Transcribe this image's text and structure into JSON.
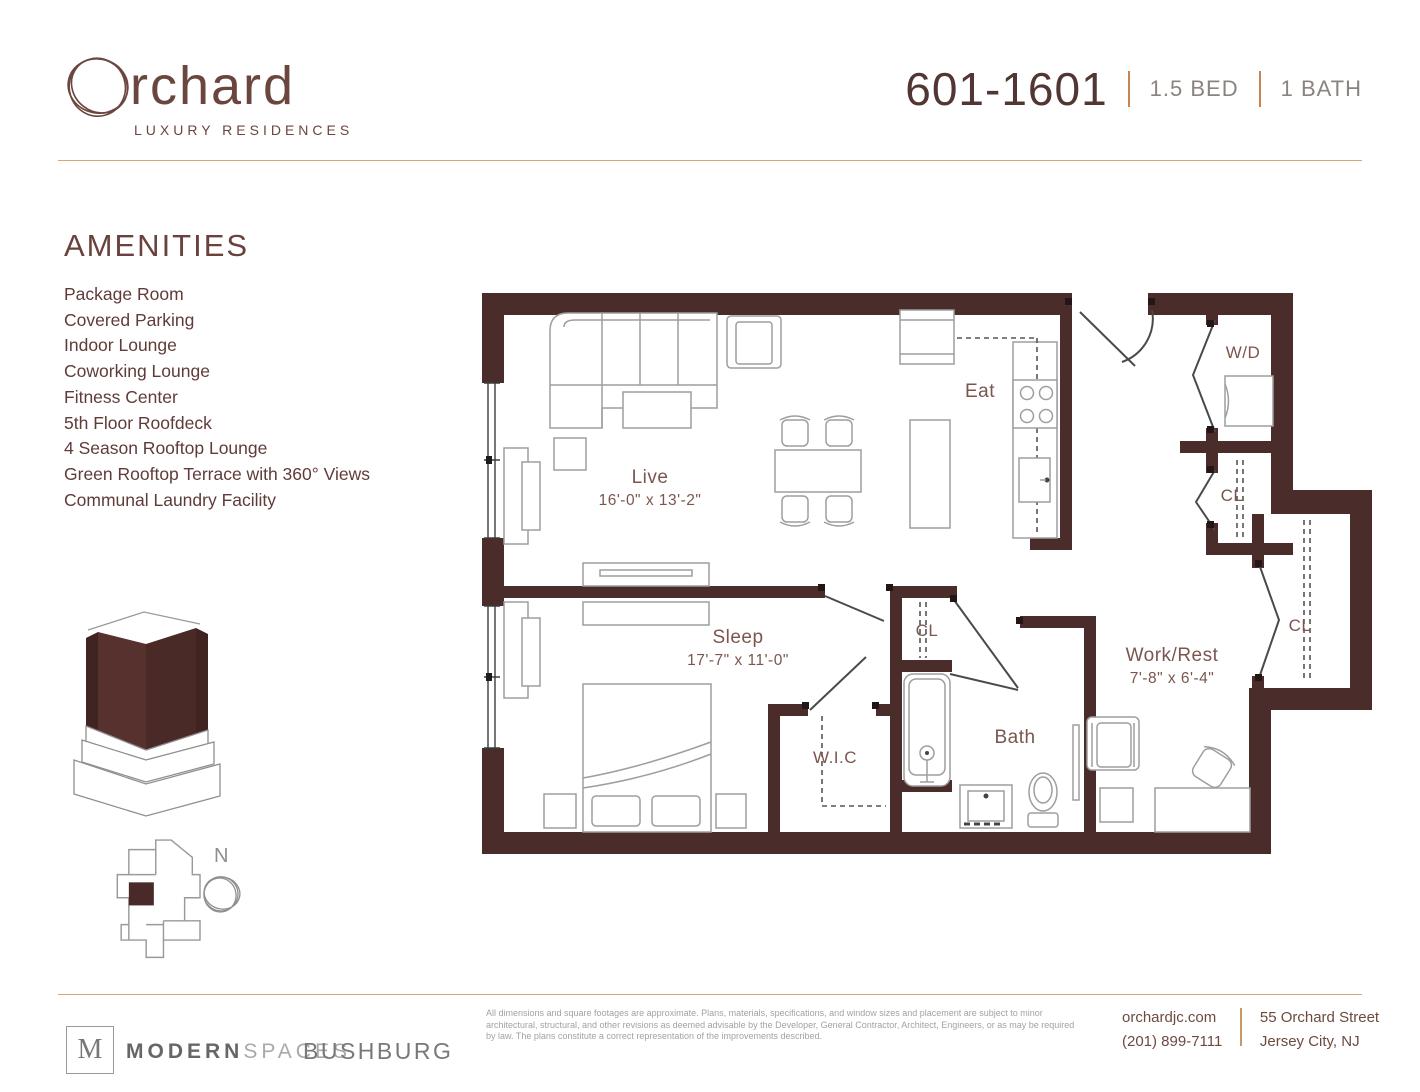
{
  "brand": {
    "name_initial": "O",
    "name_rest": "rchard",
    "tagline": "LUXURY RESIDENCES"
  },
  "unit": {
    "number": "601-1601",
    "bed": "1.5 BED",
    "bath": "1 BATH"
  },
  "amenities": {
    "title": "AMENITIES",
    "items": [
      "Package Room",
      "Covered Parking",
      "Indoor Lounge",
      "Coworking Lounge",
      "Fitness Center",
      "5th Floor Roofdeck",
      "4 Season Rooftop Lounge",
      "Green Rooftop Terrace with 360° Views",
      "Communal Laundry Facility"
    ]
  },
  "floorplan": {
    "rooms": [
      {
        "name": "Live",
        "dims": "16'-0\" x 13'-2\""
      },
      {
        "name": "Eat",
        "dims": ""
      },
      {
        "name": "W/D",
        "dims": ""
      },
      {
        "name": "CL",
        "dims": ""
      },
      {
        "name": "CL",
        "dims": ""
      },
      {
        "name": "Sleep",
        "dims": "17'-7\" x 11'-0\""
      },
      {
        "name": "CL",
        "dims": ""
      },
      {
        "name": "W.I.C",
        "dims": ""
      },
      {
        "name": "Bath",
        "dims": ""
      },
      {
        "name": "Work/Rest",
        "dims": "7'-8\" x 6'-4\""
      }
    ],
    "north_label": "N"
  },
  "footer": {
    "modernspaces_initial": "M",
    "modernspaces_bold": "MODERN",
    "modernspaces_light": "SPACES",
    "bushburg": "BUSHBURG",
    "disclaimer": "All dimensions and square footages are approximate. Plans, materials, specifications, and window sizes and placement are subject to minor architectural, structural, and other revisions as deemed advisable by the Developer, General Contractor, Architect, Engineers, or as may be required by law. The plans constitute a correct representation of the improvements described.",
    "website": "orchardjc.com",
    "phone": "(201) 899-7111",
    "address_line1": "55 Orchard Street",
    "address_line2": "Jersey City, NJ"
  },
  "colors": {
    "wall": "#4a2c2a",
    "brand_maroon": "#6b463f",
    "text_maroon": "#5f3c39",
    "accent_tan": "#c9834e",
    "rule_tan": "#d4a678",
    "furniture_gray": "#9e9e9e",
    "footer_gray": "#a2a2a2"
  }
}
